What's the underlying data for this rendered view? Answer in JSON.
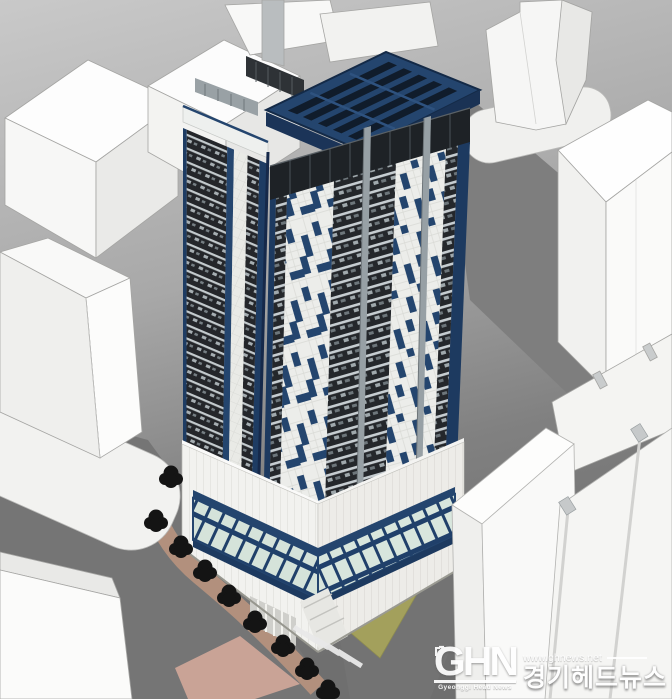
{
  "watermark": {
    "logo_text": "GHN",
    "logo_subtext": "Gyeonggi Head News",
    "site_url": "www.ghnews.net",
    "site_name_korean": "경기헤드뉴스"
  },
  "palette": {
    "tower_navy": "#24456e",
    "tower_navy_dark": "#16294a",
    "penthouse_dark": "#1e2226",
    "facade_white": "#ecedea",
    "window_wall_dark": "#24272b",
    "massing_white": "#f8f8f7",
    "road_gray": "#7b7b7b",
    "ground_light_gray": "#c9c9c9",
    "lawn_olive": "#a3a05c",
    "sidewalk_tan": "#b2907d",
    "crosswalk_pink": "#c9a396",
    "tree_black": "#141414",
    "glass_green": "#d5e3da"
  },
  "scene": {
    "subject": "3D massing rendering of a navy-and-white high-rise tower with glazed podium, white block buildings, streets and street trees",
    "tree_count": 9
  }
}
